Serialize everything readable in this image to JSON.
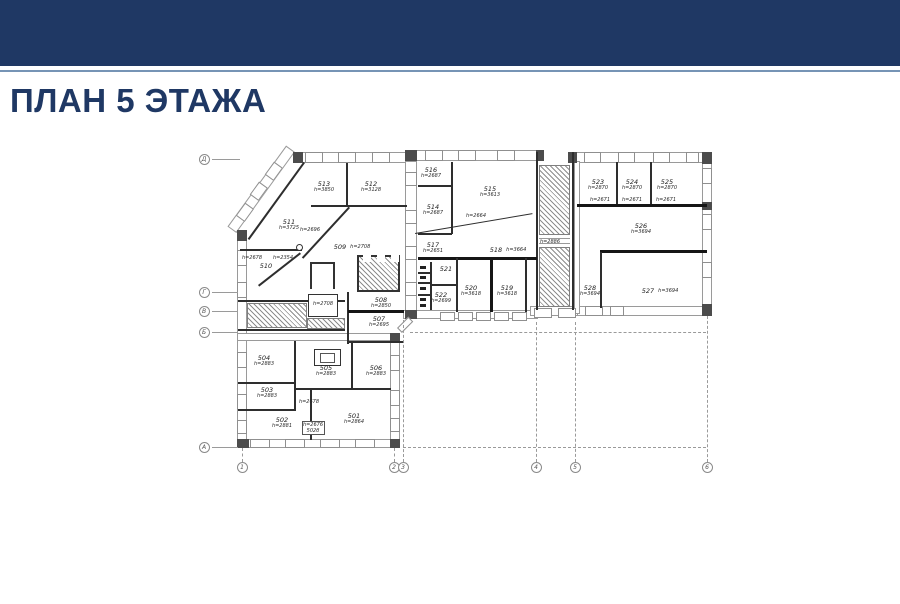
{
  "header": {
    "band_color": "#1f3864",
    "rule_color": "#7694b5",
    "title": "ПЛАН 5 ЭТАЖА",
    "title_color": "#1f3864"
  },
  "plan": {
    "line_color": "#2e2e2e",
    "rooms": [
      {
        "a": "513",
        "b": "h=3850",
        "x": 324,
        "y": 181
      },
      {
        "a": "512",
        "b": "h=3128",
        "x": 371,
        "y": 181
      },
      {
        "a": "511",
        "b": "h=3725",
        "x": 289,
        "y": 219
      },
      {
        "a": "510",
        "x": 266,
        "y": 263
      },
      {
        "a": "509",
        "b": "h=2708",
        "x": 352,
        "y": 239,
        "inline": true
      },
      {
        "a": "516",
        "b": "h=2687",
        "x": 431,
        "y": 167
      },
      {
        "a": "514",
        "b": "h=2687",
        "x": 433,
        "y": 204
      },
      {
        "a": "515",
        "b": "h=3613",
        "x": 490,
        "y": 186
      },
      {
        "a": "517",
        "b": "h=2651",
        "x": 433,
        "y": 242
      },
      {
        "a": "518",
        "b": "h=3664",
        "x": 508,
        "y": 242,
        "inline": true
      },
      {
        "a": "521",
        "x": 446,
        "y": 266
      },
      {
        "a": "520",
        "b": "h=3618",
        "x": 471,
        "y": 285
      },
      {
        "a": "519",
        "b": "h=3618",
        "x": 507,
        "y": 285
      },
      {
        "a": "522",
        "b": "h=2699",
        "x": 441,
        "y": 292
      },
      {
        "a": "523",
        "b": "h=2870",
        "x": 598,
        "y": 179
      },
      {
        "a": "524",
        "b": "h=2870",
        "x": 632,
        "y": 179
      },
      {
        "a": "525",
        "b": "h=2870",
        "x": 667,
        "y": 179
      },
      {
        "a": "526",
        "b": "h=3694",
        "x": 641,
        "y": 223
      },
      {
        "a": "528",
        "b": "h=3694",
        "x": 590,
        "y": 285
      },
      {
        "a": "527",
        "b": "h=3694",
        "x": 660,
        "y": 283,
        "inline": true
      },
      {
        "a": "508",
        "b": "h=2850",
        "x": 381,
        "y": 297
      },
      {
        "a": "507",
        "b": "h=2695",
        "x": 379,
        "y": 316
      },
      {
        "a": "504",
        "b": "h=2883",
        "x": 264,
        "y": 355
      },
      {
        "a": "505",
        "b": "h=2883",
        "x": 326,
        "y": 365
      },
      {
        "a": "506",
        "b": "h=2883",
        "x": 376,
        "y": 365
      },
      {
        "a": "503",
        "b": "h=2883",
        "x": 267,
        "y": 387
      },
      {
        "a": "502",
        "b": "h=2881",
        "x": 282,
        "y": 417
      },
      {
        "a": "501",
        "b": "h=2864",
        "x": 354,
        "y": 413
      }
    ],
    "annotations": [
      {
        "b": "h=2678",
        "x": 252,
        "y": 256
      },
      {
        "b": "h=2354",
        "x": 283,
        "y": 256
      },
      {
        "b": "h=2696",
        "x": 310,
        "y": 228
      },
      {
        "b": "h=2664",
        "x": 476,
        "y": 214
      },
      {
        "b": "h=2886",
        "x": 550,
        "y": 240
      },
      {
        "b": "h=2671",
        "x": 600,
        "y": 198
      },
      {
        "b": "h=2671",
        "x": 632,
        "y": 198
      },
      {
        "b": "h=2671",
        "x": 666,
        "y": 198
      },
      {
        "b": "h=2708",
        "x": 323,
        "y": 302
      },
      {
        "b": "h=2678",
        "x": 309,
        "y": 400
      },
      {
        "b": "h=2676",
        "x": 313,
        "y": 423
      },
      {
        "b": "502б",
        "x": 313,
        "y": 429
      }
    ],
    "grid_left": [
      {
        "label": "Д",
        "x": 204,
        "y": 159
      },
      {
        "label": "Г",
        "x": 204,
        "y": 292
      },
      {
        "label": "В",
        "x": 204,
        "y": 311
      },
      {
        "label": "Б",
        "x": 204,
        "y": 332
      },
      {
        "label": "А",
        "x": 204,
        "y": 447
      }
    ],
    "grid_bottom": [
      {
        "label": "1",
        "x": 242,
        "y": 467
      },
      {
        "label": "2",
        "x": 394,
        "y": 467
      },
      {
        "label": "3",
        "x": 403,
        "y": 467
      },
      {
        "label": "4",
        "x": 536,
        "y": 467
      },
      {
        "label": "5",
        "x": 575,
        "y": 467
      },
      {
        "label": "6",
        "x": 707,
        "y": 467
      }
    ]
  }
}
